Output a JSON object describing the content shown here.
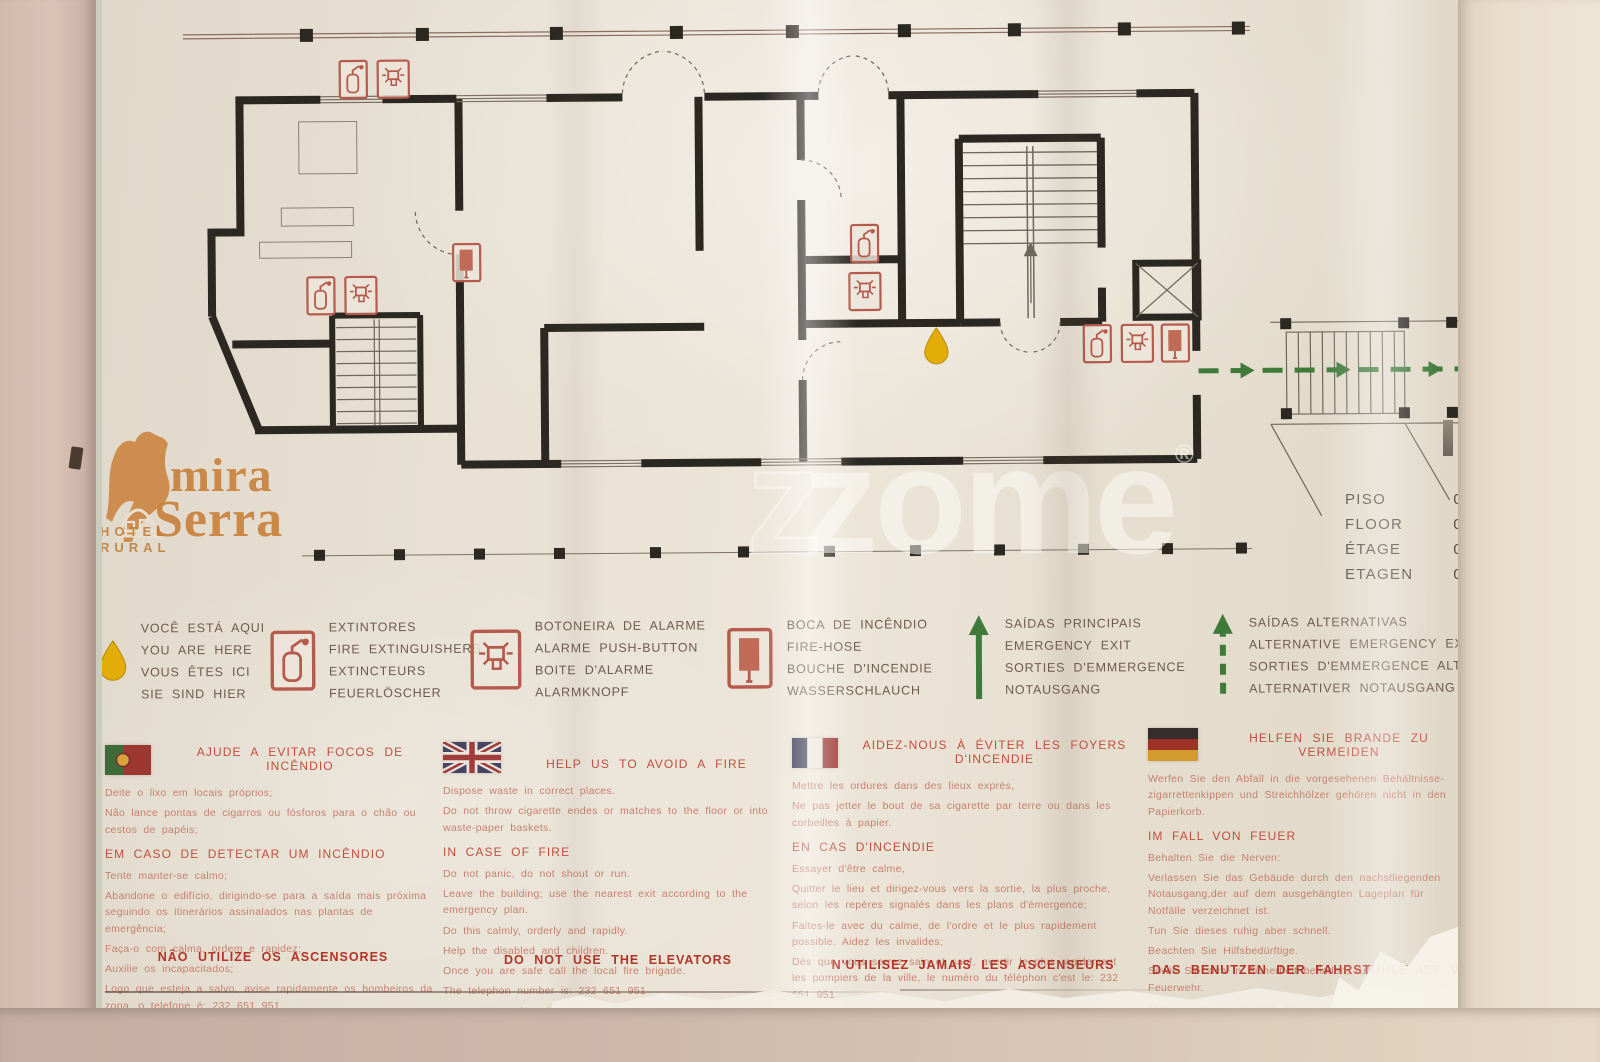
{
  "watermark": {
    "outline_letter": "z",
    "text": "zome",
    "reg": "®"
  },
  "logo": {
    "word1": "mira",
    "word2": "Serra",
    "sub1": "HOTEL",
    "sub2": "RURAL"
  },
  "floor_info": {
    "rows": [
      {
        "label": "PISO",
        "value": "0"
      },
      {
        "label": "FLOOR",
        "value": "0"
      },
      {
        "label": "ÉTAGE",
        "value": "0"
      },
      {
        "label": "ETAGEN",
        "value": "0"
      }
    ]
  },
  "legend": {
    "items": [
      {
        "icon": "yellow-drop-icon",
        "lines": [
          "VOCÊ ESTÁ AQUI",
          "YOU ARE HERE",
          "VOUS ÊTES ICI",
          "SIE SIND HIER"
        ]
      },
      {
        "icon": "fire-extinguisher-icon",
        "lines": [
          "EXTINTORES",
          "FIRE EXTINGUISHERS",
          "EXTINCTEURS",
          "FEUERLÖSCHER"
        ]
      },
      {
        "icon": "alarm-push-button-icon",
        "lines": [
          "BOTONEIRA DE ALARME",
          "ALARME PUSH-BUTTON",
          "BOITE D'ALARME",
          "ALARMKNOPF"
        ]
      },
      {
        "icon": "fire-hose-icon",
        "lines": [
          "BOCA DE INCÊNDIO",
          "FIRE-HOSE",
          "BOUCHE D'INCENDIE",
          "WASSERSCHLAUCH"
        ]
      },
      {
        "icon": "solid-green-arrow-icon",
        "lines": [
          "SAÍDAS PRINCIPAIS",
          "EMERGENCY EXIT",
          "SORTIES D'EMMERGENCE",
          "NOTAUSGANG"
        ]
      },
      {
        "icon": "dashed-green-arrow-icon",
        "lines": [
          "SAÍDAS ALTERNATIVAS",
          "ALTERNATIVE EMERGENCY EXIT",
          "SORTIES D'EMMERGENCE ALTERNATIVE",
          "ALTERNATIVER NOTAUSGANG"
        ]
      }
    ]
  },
  "columns": [
    {
      "lang": "pt",
      "flag": "portugal-flag",
      "title": "AJUDE A EVITAR FOCOS DE INCÊNDIO",
      "intro": [
        "Deite o lixo em locais próprios;",
        "Não lance pontas de cigarros ou fósforos para o chão ou cestos de papéis;"
      ],
      "subtitle": "EM CASO DE DETECTAR UM INCÊNDIO",
      "body": [
        "Tente manter-se calmo;",
        "Abandone o edifício, dirigindo-se para a saída mais próxima seguindo os itinerários assinalados nas plantas de emergência;",
        "Faça-o com calma, ordem e rapidez;",
        "Auxilie os incapacitados;",
        "Logo que esteja a salvo, avise rapidamente os bombeiros da zona, o telefone é:  232 651 951",
        "Não volte ao edifício enquanto decorrer o combate ao incêndio."
      ],
      "footer": "NÃO UTILIZE OS ASCENSORES"
    },
    {
      "lang": "en",
      "flag": "uk-flag",
      "title": "HELP US TO AVOID A FIRE",
      "intro": [
        "Dispose waste in correct places.",
        "Do not throw cigarette endes or matches to the floor or into waste-paper baskets."
      ],
      "subtitle": "IN CASE OF FIRE",
      "body": [
        "Do not panic, do not shout or run.",
        "Leave the building; use the nearest exit according to the emergency plan.",
        "Do this calmly, orderly and rapidly.",
        "Help the disabled and children.",
        "Once you are safe call the local fire brigade.",
        "The telephon number is:  232 651 951",
        "Do not return into the building whilst the fire combat is taking place."
      ],
      "footer": "DO NOT USE THE ELEVATORS"
    },
    {
      "lang": "fr",
      "flag": "france-flag",
      "title": "AIDEZ-NOUS À ÉVITER LES FOYERS D'INCENDIE",
      "intro": [
        "Mettre les ordures dans des lieux exprès,",
        "Ne pas jetter le bout de sa cigarette par terre ou dans les corbeilles à papier."
      ],
      "subtitle": "EN CAS D'INCENDIE",
      "body": [
        "Essayer d'être calme,",
        "Quitter le lieu et dirigez-vous vers la sortie, la plus proche, selon les repères signalés dans les plans d'émergence;",
        "Faites-le avec du calme, de l'ordre et le plus rapidement possible.  Aidez les invalides;",
        "Dès que vous serrez sain et sauf, avertir le plus rapidement les pompiers de la ville, le numéro du téléphon  c'est le:  232 651 951",
        "Restez sur place pendant toute l'opération de combat à l'incendie."
      ],
      "footer": "N'UTILISEZ JAMAIS LES ASCENSEURS"
    },
    {
      "lang": "de",
      "flag": "germany-flag",
      "title": "HELFEN SIE BRANDE ZU VERMEIDEN",
      "intro": [
        "Werfen Sie den Abfall in die vorgesehenen Behältnisse-zigarrettenkippen und Streichhölzer gehören nicht in den Papierkorb."
      ],
      "subtitle": "IM FALL VON FEUER",
      "body": [
        "Behalten Sie die Nerven:",
        "Verlassen Sie das Gebäude durch den nachstliegenden Notausgang,der auf dem ausgehängten Lageplan für Notfälle verzeichnet ist.",
        "Tun Sie dieses ruhig aber schnell.",
        "Beachten Sie Hilfsbedürftige.",
        "Sowie Sie sich in Sicherheit befinden, rufen Sie die Feuerwehr.",
        "Telefonnummer:  232 651 951",
        "Während der Löscharbeiten gehen Sie nicht zurück ins Gebäude."
      ],
      "footer": "DAS BENUTZEN DER FAHRSTUHLE IST VERBOTEN"
    }
  ],
  "colors": {
    "safety_red": "#b55a4c",
    "exit_green": "#3f7a3a",
    "you_are_here_yellow": "#e2ac09",
    "logo_orange": "#c9823d",
    "heading_red": "#c24e3e",
    "paper": "#e6dfd2",
    "wall_pink": "#d5bbae"
  }
}
